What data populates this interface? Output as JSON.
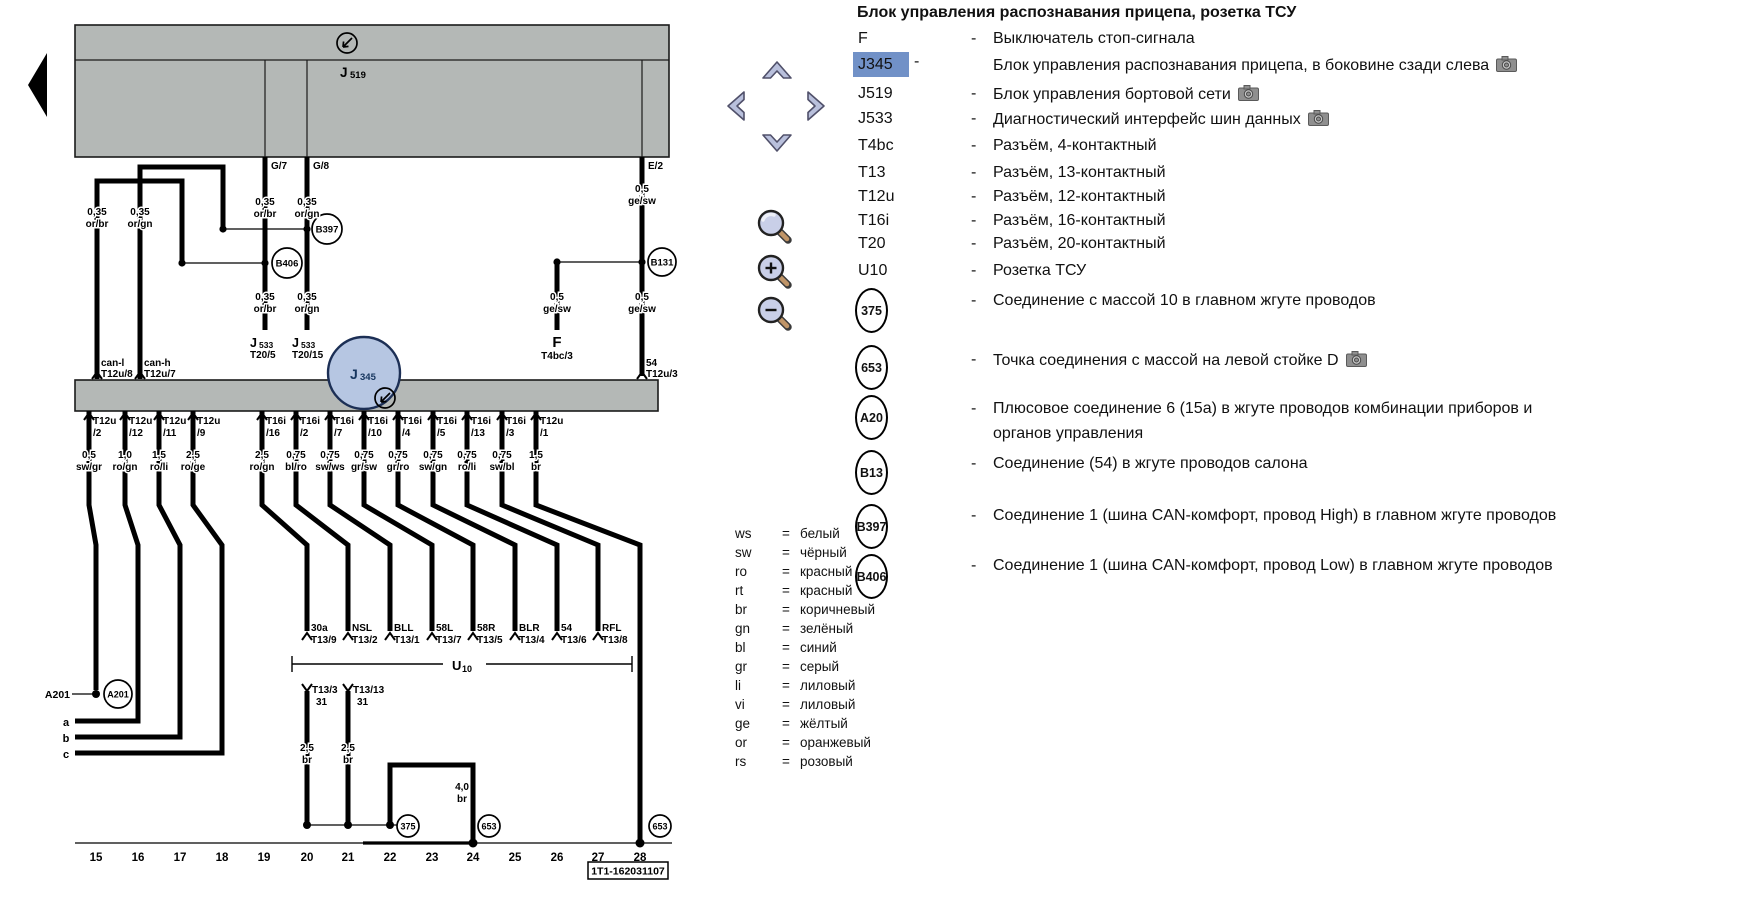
{
  "colors": {
    "highlight": "#7191c7",
    "selection_fill": "#b6c6e2",
    "selection_stroke": "#1c2f55",
    "box_gray": "#b4b8b6",
    "nav_icon": "#b9c0dc",
    "magnifier_handle": "#c09568"
  },
  "icons": {
    "nav": [
      "up-chevron",
      "left-chevron",
      "right-chevron",
      "down-chevron"
    ],
    "zoom": [
      "magnifier",
      "magnifier-plus",
      "magnifier-minus"
    ],
    "back": "back-arrow",
    "camera": "camera"
  },
  "legend": {
    "title": "Блок управления распознавания прицепа, розетка ТСУ",
    "dash": "-",
    "eq": "=",
    "rows": [
      {
        "code": "F",
        "desc": "Выключатель стоп-сигнала"
      },
      {
        "code": "J345",
        "desc": "Блок управления распознавания прицепа, в боковине сзади слева",
        "camera": true,
        "highlight": true
      },
      {
        "code": "J519",
        "desc": "Блок управления бортовой сети",
        "camera": true
      },
      {
        "code": "J533",
        "desc": "Диагностический интерфейс шин данных",
        "camera": true
      },
      {
        "code": "T4bc",
        "desc": "Разъём, 4-контактный"
      },
      {
        "code": "T13",
        "desc": "Разъём, 13-контактный"
      },
      {
        "code": "T12u",
        "desc": "Разъём, 12-контактный"
      },
      {
        "code": "T16i",
        "desc": "Разъём, 16-контактный"
      },
      {
        "code": "T20",
        "desc": "Разъём, 20-контактный"
      },
      {
        "code": "U10",
        "desc": "Розетка ТСУ"
      },
      {
        "code": "375",
        "circled": true,
        "desc": "Соединение с массой 10 в главном жгуте проводов"
      },
      {
        "code": "653",
        "circled": true,
        "desc": "Точка соединения с массой на левой стойке D",
        "camera": true
      },
      {
        "code": "A20",
        "circled": true,
        "desc": "Плюсовое соединение 6 (15а) в жгуте проводов комбинации приборов и",
        "desc2": "органов управления"
      },
      {
        "code": "B13",
        "circled": true,
        "desc": "Соединение (54) в жгуте проводов салона"
      },
      {
        "code": "B397",
        "circled": true,
        "desc": "Соединение 1 (шина CAN-комфорт, провод High) в главном жгуте проводов"
      },
      {
        "code": "B406",
        "circled": true,
        "desc": "Соединение 1 (шина CAN-комфорт, провод Low) в главном жгуте проводов"
      }
    ]
  },
  "color_codes": [
    {
      "code": "ws",
      "name": "белый"
    },
    {
      "code": "sw",
      "name": "чёрный"
    },
    {
      "code": "ro",
      "name": "красный"
    },
    {
      "code": "rt",
      "name": "красный"
    },
    {
      "code": "br",
      "name": "коричневый"
    },
    {
      "code": "gn",
      "name": "зелёный"
    },
    {
      "code": "bl",
      "name": "синий"
    },
    {
      "code": "gr",
      "name": "серый"
    },
    {
      "code": "li",
      "name": "лиловый"
    },
    {
      "code": "vi",
      "name": "лиловый"
    },
    {
      "code": "ge",
      "name": "жёлтый"
    },
    {
      "code": "or",
      "name": "оранжевый"
    },
    {
      "code": "rs",
      "name": "розовый"
    }
  ],
  "diagram": {
    "j": "J",
    "n519": "519",
    "n533": "533",
    "n345": "345",
    "g7": "G/7",
    "g8": "G/8",
    "e2": "E/2",
    "can_l": "can-l",
    "can_l_pin": "T12u/8",
    "can_h": "can-h",
    "can_h_pin": "T12u/7",
    "t20_5": "T20/5",
    "t20_15": "T20/15",
    "f_code": "F",
    "f_pin": "T4bc/3",
    "e2_fn": "54",
    "e2_pin": "T12u/3",
    "b397": "B397",
    "b406": "B406",
    "b131": "B131",
    "a201": "A201",
    "a201_left": "A201",
    "g375": "375",
    "g653": "653",
    "la": "a",
    "lb": "b",
    "lc": "c",
    "u": "U",
    "u_sub": "10",
    "t13_3": "T13/3",
    "t13_13": "T13/13",
    "pin31": "31",
    "sheet_id": "1T1-162031107",
    "tracks": [
      "15",
      "16",
      "17",
      "18",
      "19",
      "20",
      "21",
      "22",
      "23",
      "24",
      "25",
      "26",
      "27",
      "28"
    ],
    "conns": [
      {
        "t": "T12u",
        "p": "/2"
      },
      {
        "t": "T12u",
        "p": "/12"
      },
      {
        "t": "T12u",
        "p": "/11"
      },
      {
        "t": "T12u",
        "p": "/9"
      },
      {
        "t": "T16i",
        "p": "/16"
      },
      {
        "t": "T16i",
        "p": "/2"
      },
      {
        "t": "T16i",
        "p": "/7"
      },
      {
        "t": "T16i",
        "p": "/10"
      },
      {
        "t": "T16i",
        "p": "/4"
      },
      {
        "t": "T16i",
        "p": "/5"
      },
      {
        "t": "T16i",
        "p": "/13"
      },
      {
        "t": "T16i",
        "p": "/3"
      },
      {
        "t": "T12u",
        "p": "/1"
      }
    ],
    "wire_labels": [
      {
        "s": "0,5",
        "c": "sw/gr"
      },
      {
        "s": "1,0",
        "c": "ro/gn"
      },
      {
        "s": "1,5",
        "c": "ro/li"
      },
      {
        "s": "2,5",
        "c": "ro/ge"
      },
      {
        "s": "2,5",
        "c": "ro/gn"
      },
      {
        "s": "0,75",
        "c": "bl/ro"
      },
      {
        "s": "0,75",
        "c": "sw/ws"
      },
      {
        "s": "0,75",
        "c": "gr/sw"
      },
      {
        "s": "0,75",
        "c": "gr/ro"
      },
      {
        "s": "0,75",
        "c": "sw/gn"
      },
      {
        "s": "0,75",
        "c": "ro/li"
      },
      {
        "s": "0,75",
        "c": "sw/bl"
      },
      {
        "s": "1,5",
        "c": "br"
      }
    ],
    "t13_targets": [
      {
        "f": "30a",
        "p": "T13/9"
      },
      {
        "f": "NSL",
        "p": "T13/2"
      },
      {
        "f": "BLL",
        "p": "T13/1"
      },
      {
        "f": "58L",
        "p": "T13/7"
      },
      {
        "f": "58R",
        "p": "T13/5"
      },
      {
        "f": "BLR",
        "p": "T13/4"
      },
      {
        "f": "54",
        "p": "T13/6"
      },
      {
        "f": "RFL",
        "p": "T13/8"
      }
    ],
    "top_gauges": {
      "can_l": {
        "s": "0,35",
        "c": "or/br"
      },
      "can_h": {
        "s": "0,35",
        "c": "or/gn"
      },
      "g7u": {
        "s": "0,35",
        "c": "or/br"
      },
      "g8u": {
        "s": "0,35",
        "c": "or/gn"
      },
      "g7d": {
        "s": "0,35",
        "c": "or/br"
      },
      "g8d": {
        "s": "0,35",
        "c": "or/gn"
      },
      "e2u": {
        "s": "0,5",
        "c": "ge/sw"
      },
      "e2d": {
        "s": "0,5",
        "c": "ge/sw"
      },
      "fst": {
        "s": "0,5",
        "c": "ge/sw"
      }
    },
    "gnd_gauges": {
      "d1": {
        "s": "2,5",
        "c": "br"
      },
      "d2": {
        "s": "2,5",
        "c": "br"
      },
      "d3": {
        "s": "4,0",
        "c": "br"
      }
    }
  }
}
